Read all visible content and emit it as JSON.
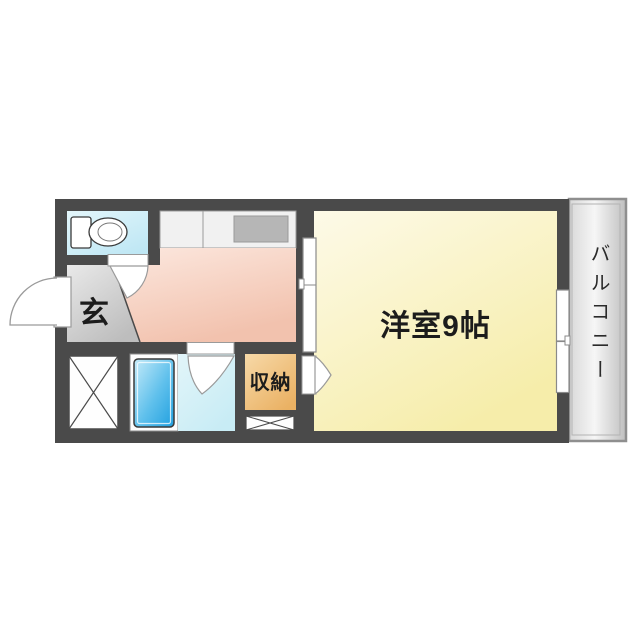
{
  "rooms": {
    "western_room": {
      "label": "洋室9帖"
    },
    "balcony": {
      "label": "バルコニー"
    },
    "entrance": {
      "label": "玄"
    },
    "storage": {
      "label": "収納"
    }
  },
  "fixtures": {
    "toilet": "toilet-icon",
    "bathtub": "bathtub-icon",
    "kitchen_counter": "kitchen-counter",
    "stove": "stove-top",
    "large_cross_box": "closet-x-large",
    "small_cross_box": "closet-x-small"
  },
  "colors": {
    "wall": "#4a4a4a",
    "western_room": "#f6edaa",
    "kitchen": "#f2c2ae",
    "entrance": "#c9c9c9",
    "toilet_room": "#c8ebf6",
    "washroom": "#cdeef6",
    "bathtub": "#1f9fdf",
    "storage": "#eab163",
    "balcony": "#e0e0e0",
    "door_outline": "#9a9a9a"
  }
}
